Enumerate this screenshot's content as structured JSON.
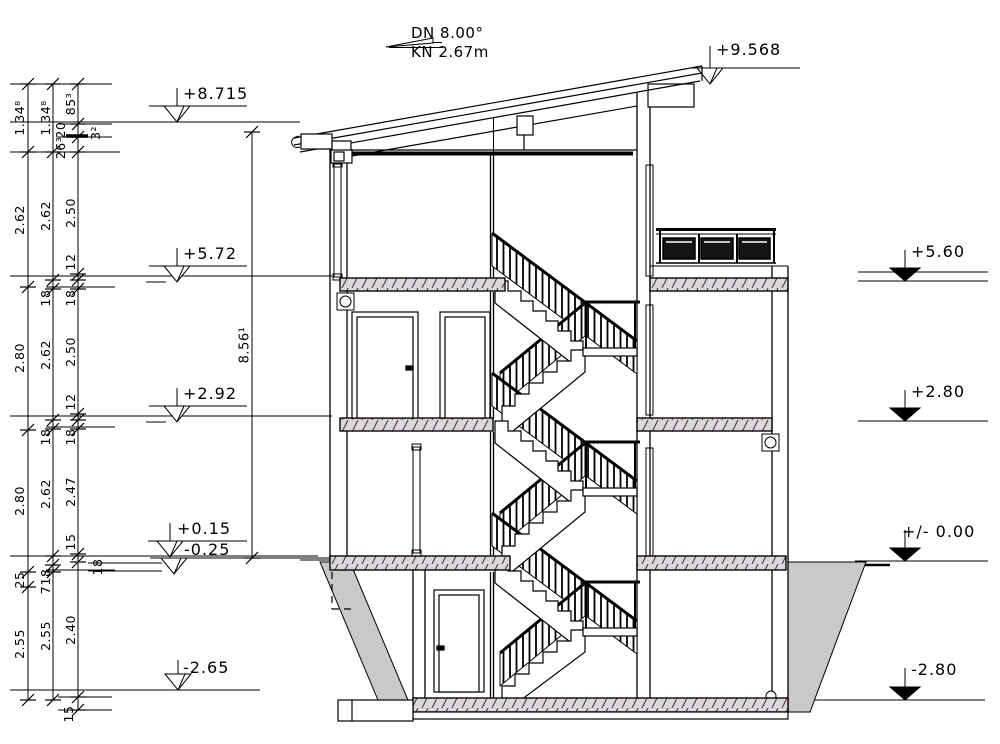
{
  "title_annotation": {
    "roof_pitch": "DN 8.00°",
    "roof_eave": "KN 2.67m"
  },
  "levels_left": [
    "+8.715",
    "+5.72",
    "+2.92",
    "+0.15",
    "-0.25",
    "-2.65"
  ],
  "levels_right": [
    "+9.568",
    "+5.60",
    "+2.80",
    "+/- 0.00",
    "-2.80"
  ],
  "dimensions": {
    "chain_outer": [
      "1.34⁸",
      "2.62",
      "2.80",
      "2.80",
      "25",
      "2.55"
    ],
    "chain_middle": [
      "1.34⁸",
      "2.62",
      "18",
      "2.62",
      "18",
      "2.62",
      "18",
      "7",
      "2.55"
    ],
    "chain_inner": [
      "85³",
      "20",
      "26³",
      "2.50",
      "12",
      "18",
      "2.50",
      "12",
      "18",
      "2.47",
      "15",
      "2.40",
      "15"
    ],
    "stair_total_height": "8.56¹",
    "eave_detail": "3²",
    "ground_slab_note": "18"
  },
  "colors": {
    "line": "#000000",
    "slab_fill": "#d9d9d9",
    "hatch_line": "#5e2f52",
    "earth_fill": "#c9c9c9",
    "panel_fill": "#151515"
  }
}
